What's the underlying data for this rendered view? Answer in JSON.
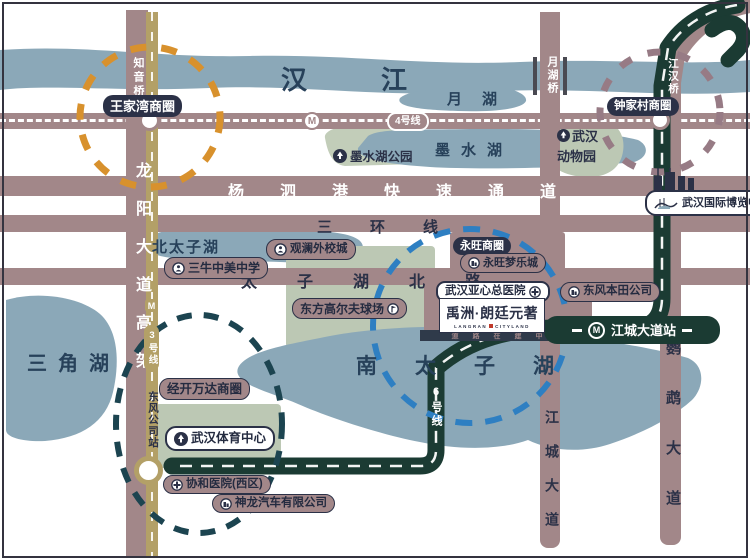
{
  "water": {
    "han_river": "汉江",
    "yue_lake": "月湖",
    "moshui_lake": "墨水湖",
    "north_taizi_lake": "北太子湖",
    "south_taizi_lake": "南太子湖",
    "triangle_lake": "三角湖"
  },
  "roads": {
    "yangsigang": "杨泗港快速通道",
    "third_ring": "三环线",
    "taizihu_north_rd": "太子湖北路",
    "longyang_ave": "龙阳大道高架",
    "zhiyin_bridge": "知音桥",
    "yuehu_bridge": "月湖桥",
    "jianghan_bridge": "江汉桥",
    "jiangcheng_ave": "江城大道",
    "yingwu_ave": "鹦鹉大道",
    "under_construction": "道路在建中"
  },
  "metro": {
    "m": "M",
    "line3": "3号线",
    "line4": "4号线",
    "line6": "6号线",
    "jiangcheng_station": "江城大道站",
    "dongfeng_station": "东风公司站"
  },
  "districts": {
    "wangjiawan": "王家湾商圈",
    "zhongjiacun": "钟家村商圈",
    "yongwang": "永旺商圈",
    "jingkai_wanda": "经开万达商圈"
  },
  "pois": {
    "moshui_park": "墨水湖公园",
    "zoo_line1": "武汉",
    "zoo_line2": "动物园",
    "expo_center": "武汉国际博览中心",
    "sanniu_school": "三牛中美中学",
    "guanlan_school": "观澜外校城",
    "yongwang_mall": "永旺梦乐城",
    "yaxin_hospital": "武汉亚心总医院",
    "dongfeng_honda": "东风本田公司",
    "golf_course": "东方高尔夫球场",
    "sports_center": "武汉体育中心",
    "xiehe_hospital": "协和医院(西区)",
    "shenlong_auto": "神龙汽车有限公司"
  },
  "project": {
    "name": "禹洲·朗廷元著",
    "subtitle_left": "LANGRAN",
    "subtitle_right": "CITYLAND"
  },
  "colors": {
    "water": "#8BA8B8",
    "road": "#A28789",
    "park": "#BCC8B4",
    "line3_gold": "#B3A067",
    "line6_green": "#1B3B33",
    "badge_navy": "#2B3147",
    "circle_orange": "#D8912D",
    "circle_blue": "#2E7FC2",
    "circle_teal": "#1C4450",
    "circle_mauve": "#977B85",
    "accent_red": "#C03A2B"
  }
}
